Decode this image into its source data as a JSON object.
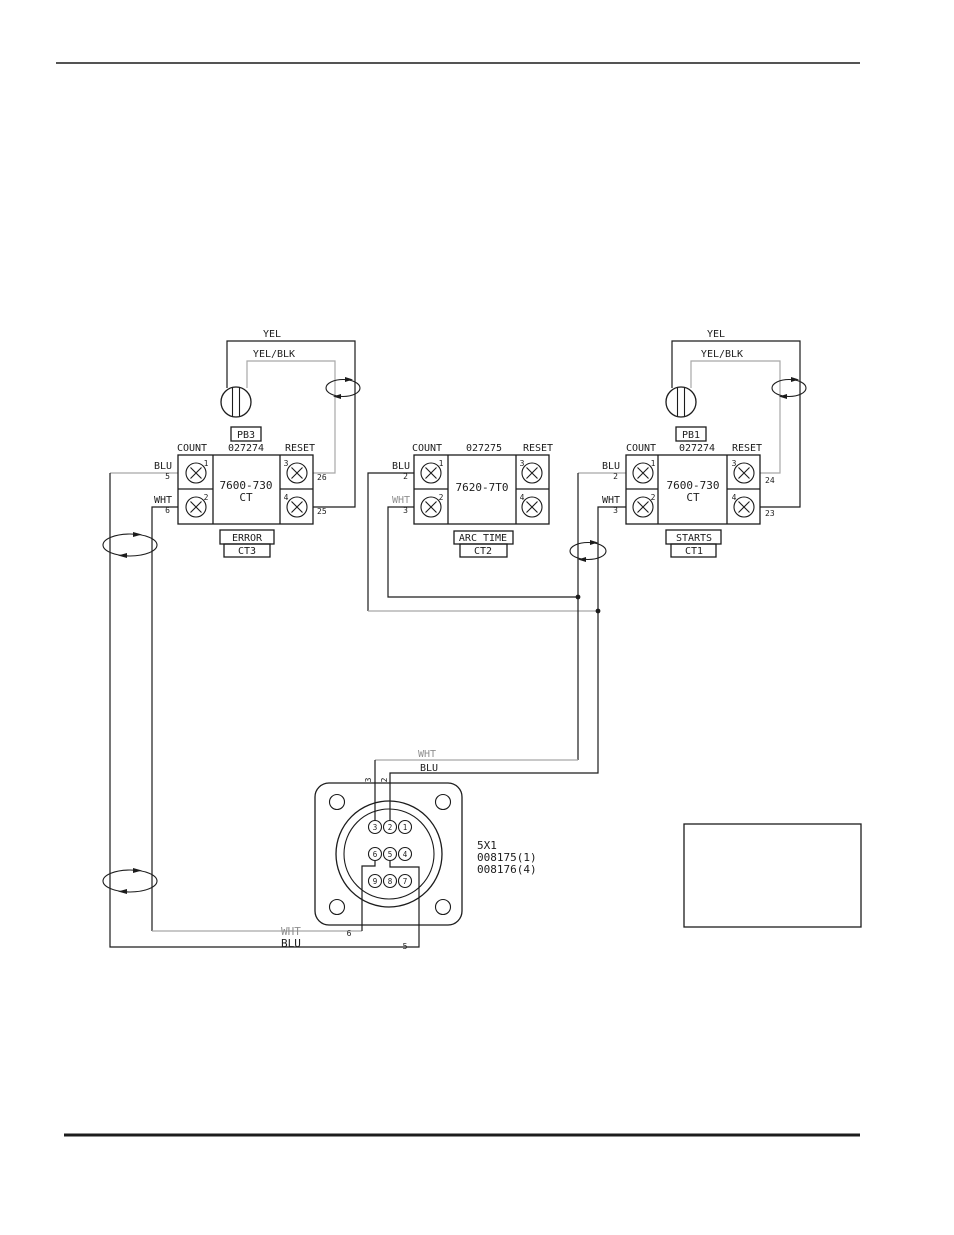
{
  "labels": {
    "yel_left": "YEL",
    "yelblk_left": "YEL/BLK",
    "yel_right": "YEL",
    "yelblk_right": "YEL/BLK",
    "wht_mid": "WHT",
    "blu_mid": "BLU",
    "wht_bot": "WHT",
    "blu_bot": "BLU",
    "pin3_wire": "3",
    "pin2_wire": "2",
    "pin6_wire": "6",
    "pin5_wire": "5"
  },
  "modules": [
    {
      "name": "CT3",
      "pb_label": "PB3",
      "part_no": "027274",
      "count_hdr": "COUNT",
      "reset_hdr": "RESET",
      "device": "7600-730",
      "device_sub": "CT",
      "function": "ERROR",
      "ref": "CT3",
      "blu_label": "BLU",
      "blu_wire": "5",
      "wht_label": "WHT",
      "wht_wire": "6",
      "term1": "1",
      "term2": "2",
      "term3": "3",
      "term4": "4",
      "wire3": "26",
      "wire4": "25"
    },
    {
      "name": "CT2",
      "part_no": "027275",
      "count_hdr": "COUNT",
      "reset_hdr": "RESET",
      "device": "7620-7T0",
      "function": "ARC TIME",
      "ref": "CT2",
      "blu_label": "BLU",
      "blu_wire": "2",
      "wht_label": "WHT",
      "wht_wire": "3",
      "term1": "1",
      "term2": "2",
      "term3": "3",
      "term4": "4"
    },
    {
      "name": "CT1",
      "pb_label": "PB1",
      "part_no": "027274",
      "count_hdr": "COUNT",
      "reset_hdr": "RESET",
      "device": "7600-730",
      "device_sub": "CT",
      "function": "STARTS",
      "ref": "CT1",
      "blu_label": "BLU",
      "blu_wire": "2",
      "wht_label": "WHT",
      "wht_wire": "3",
      "term1": "1",
      "term2": "2",
      "term3": "3",
      "term4": "4",
      "wire3": "24",
      "wire4": "23"
    }
  ],
  "connector": {
    "designator": "5X1",
    "part_a": "008175(1)",
    "part_b": "008176(4)",
    "pins": [
      "3",
      "2",
      "1",
      "6",
      "5",
      "4",
      "9",
      "8",
      "7"
    ]
  }
}
